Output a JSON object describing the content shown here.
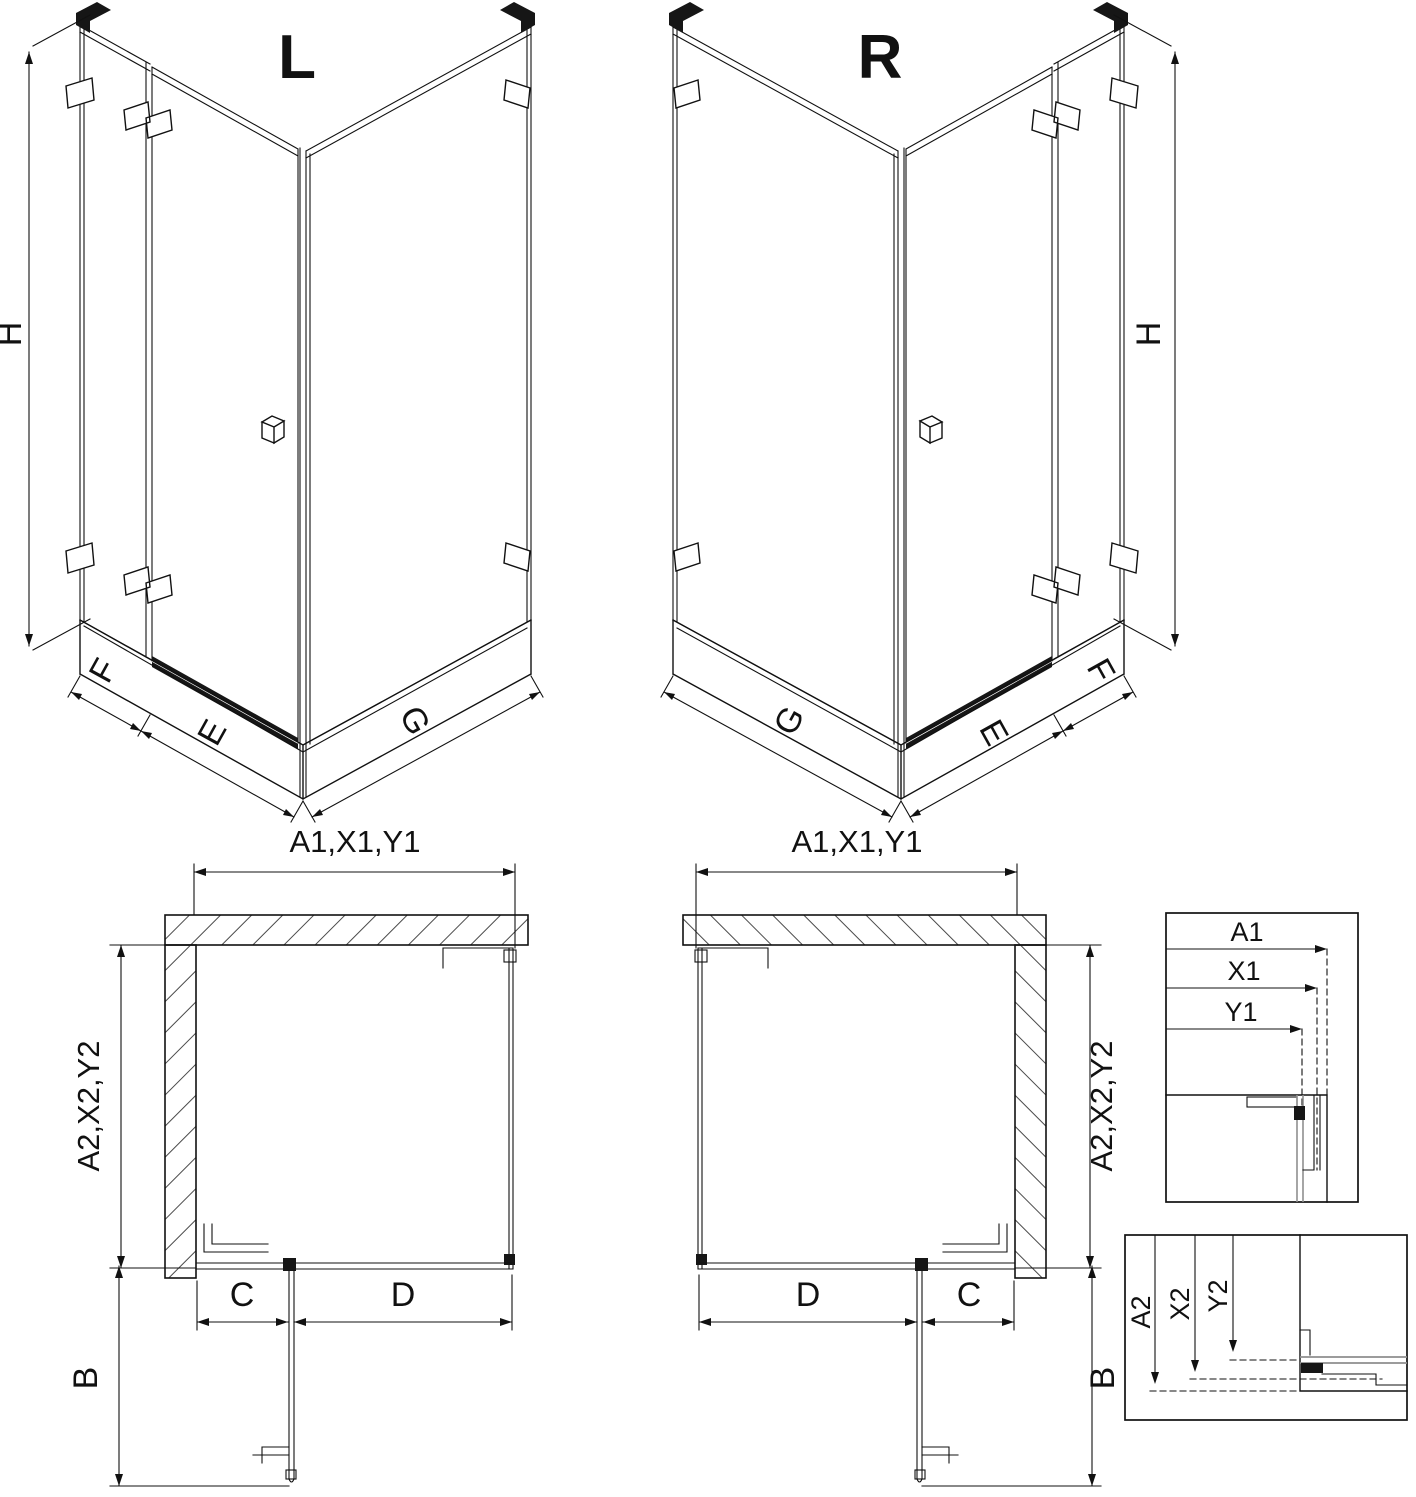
{
  "drawing": {
    "views": {
      "iso_left": {
        "label": "L",
        "dim_height": "H",
        "dim_panel_side": "F",
        "dim_door": "E",
        "dim_panel_wide": "G"
      },
      "iso_right": {
        "label": "R",
        "dim_height": "H",
        "dim_panel_side": "F",
        "dim_door": "E",
        "dim_panel_wide": "G"
      },
      "plan_left": {
        "dim_top": "A1,X1,Y1",
        "dim_side": "A2,X2,Y2",
        "dim_c": "C",
        "dim_d": "D",
        "dim_b": "B"
      },
      "plan_right": {
        "dim_top": "A1,X1,Y1",
        "dim_side": "A2,X2,Y2",
        "dim_c": "C",
        "dim_d": "D",
        "dim_b": "B"
      },
      "detail_widths": {
        "labels": [
          "A1",
          "X1",
          "Y1"
        ]
      },
      "detail_depths": {
        "labels": [
          "A2",
          "X2",
          "Y2"
        ]
      }
    },
    "colors": {
      "line": "#111111",
      "glass_gray": "#8f8f8f",
      "background": "#ffffff"
    }
  }
}
